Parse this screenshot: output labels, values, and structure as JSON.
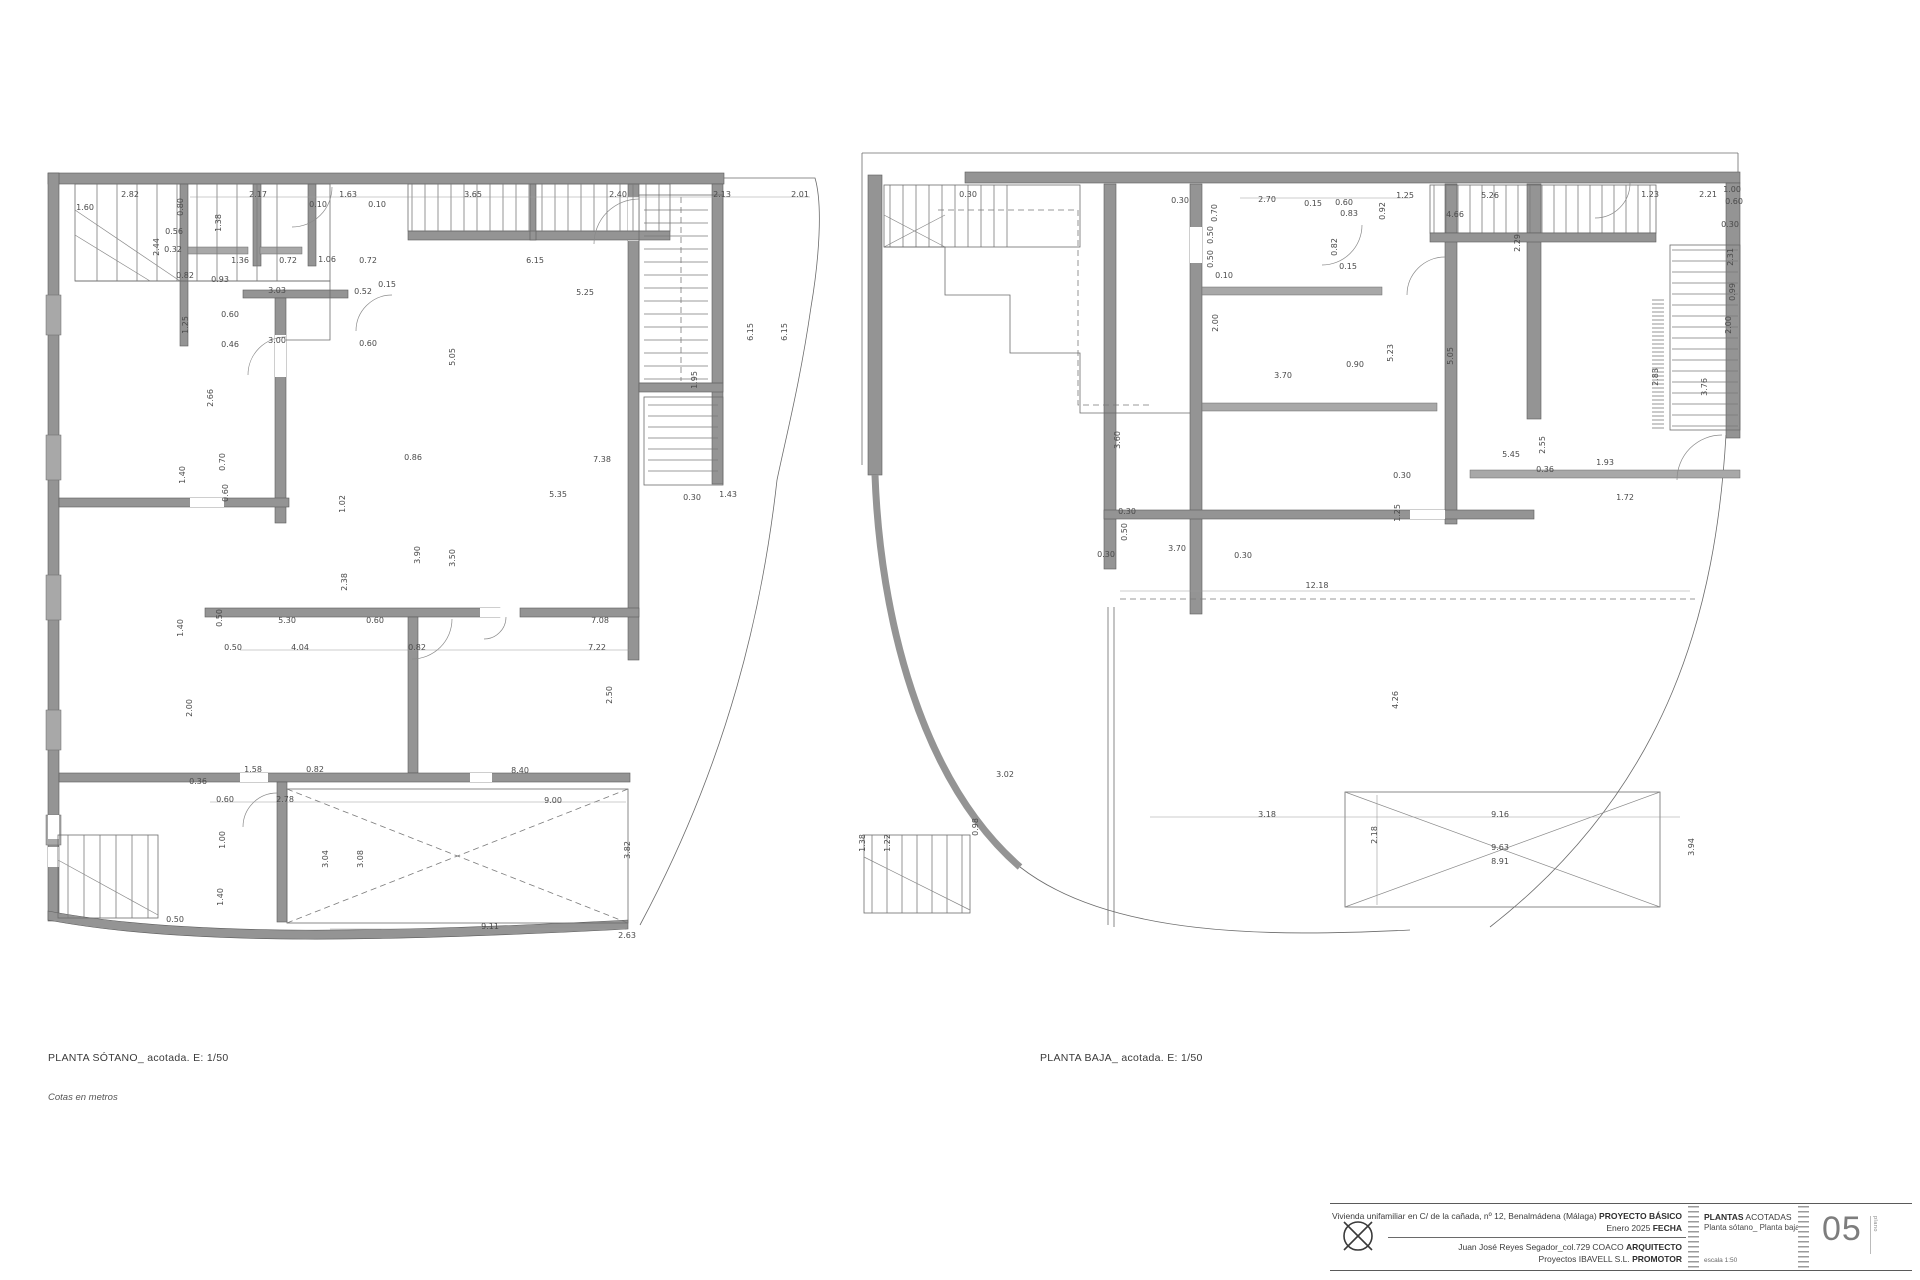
{
  "colors": {
    "wall": "#949494",
    "line": "#6b6b6b",
    "dim_text": "#4a4a4a",
    "accent": "#7d7d7d"
  },
  "labels": {
    "plan1_title": "PLANTA SÓTANO_ acotada. E: 1/50",
    "plan1_note": "Cotas en metros",
    "plan2_title": "PLANTA BAJA_ acotada. E: 1/50"
  },
  "titleblock": {
    "project": "Vivienda unifamiliar en C/ de la cañada, nº 12, Benalmádena (Málaga) ",
    "project_tag": "PROYECTO BÁSICO",
    "date": "Enero 2025 ",
    "date_tag": "FECHA",
    "architect": "Juan José Reyes Segador_col.729 COACO ",
    "architect_tag": "ARQUITECTO",
    "promoter": "Proyectos IBAVELL S.L. ",
    "promoter_tag": "PROMOTOR",
    "sheet_title_bold": "PLANTAS",
    "sheet_title_rest": " ACOTADAS",
    "sheet_subtitle": "Planta sótano_ Planta baja",
    "scale_label": "escala 1:50",
    "sheet_number": "05",
    "sheet_number_side": "plano"
  },
  "plans": [
    {
      "name": "planta-sotano",
      "dims": [
        [
          90,
          62,
          "2.82"
        ],
        [
          45,
          75,
          "1.60"
        ],
        [
          218,
          62,
          "2.17"
        ],
        [
          308,
          62,
          "1.63"
        ],
        [
          433,
          62,
          "3.65"
        ],
        [
          578,
          62,
          "2.40"
        ],
        [
          682,
          62,
          "2.13"
        ],
        [
          760,
          62,
          "2.01"
        ],
        [
          181,
          88,
          "1.38",
          "v"
        ],
        [
          119,
          112,
          "2.44",
          "v"
        ],
        [
          134,
          99,
          "0.56"
        ],
        [
          133,
          117,
          "0.32"
        ],
        [
          143,
          72,
          "0.80",
          "v"
        ],
        [
          278,
          72,
          "0.10"
        ],
        [
          337,
          72,
          "0.10"
        ],
        [
          200,
          128,
          "1.36"
        ],
        [
          248,
          128,
          "0.72"
        ],
        [
          287,
          127,
          "1.06"
        ],
        [
          328,
          128,
          "0.72"
        ],
        [
          180,
          147,
          "0.93"
        ],
        [
          145,
          143,
          "0.82"
        ],
        [
          237,
          158,
          "3.03"
        ],
        [
          323,
          159,
          "0.52"
        ],
        [
          347,
          152,
          "0.15"
        ],
        [
          190,
          182,
          "0.60"
        ],
        [
          148,
          190,
          "1.25",
          "v"
        ],
        [
          190,
          212,
          "0.46"
        ],
        [
          237,
          208,
          "3.00"
        ],
        [
          328,
          211,
          "0.60"
        ],
        [
          495,
          128,
          "6.15"
        ],
        [
          545,
          160,
          "5.25"
        ],
        [
          415,
          222,
          "5.05",
          "v"
        ],
        [
          713,
          197,
          "6.15",
          "v"
        ],
        [
          747,
          197,
          "6.15",
          "v"
        ],
        [
          657,
          245,
          "1.95",
          "v"
        ],
        [
          562,
          327,
          "7.38"
        ],
        [
          518,
          362,
          "5.35"
        ],
        [
          652,
          365,
          "0.30"
        ],
        [
          688,
          362,
          "1.43"
        ],
        [
          305,
          369,
          "1.02",
          "v"
        ],
        [
          380,
          420,
          "3.90",
          "v"
        ],
        [
          415,
          423,
          "3.50",
          "v"
        ],
        [
          307,
          447,
          "2.38",
          "v"
        ],
        [
          173,
          263,
          "2.66",
          "v"
        ],
        [
          185,
          327,
          "0.70",
          "v"
        ],
        [
          145,
          340,
          "1.40",
          "v"
        ],
        [
          188,
          358,
          "0.60",
          "v"
        ],
        [
          373,
          325,
          "0.86"
        ],
        [
          143,
          493,
          "1.40",
          "v"
        ],
        [
          182,
          483,
          "0.50",
          "v"
        ],
        [
          247,
          488,
          "5.30"
        ],
        [
          335,
          488,
          "0.60"
        ],
        [
          560,
          488,
          "7.08"
        ],
        [
          193,
          515,
          "0.50"
        ],
        [
          260,
          515,
          "4.04"
        ],
        [
          377,
          515,
          "0.82"
        ],
        [
          557,
          515,
          "7.22"
        ],
        [
          152,
          573,
          "2.00",
          "v"
        ],
        [
          572,
          560,
          "2.50",
          "v"
        ],
        [
          213,
          637,
          "1.58"
        ],
        [
          275,
          637,
          "0.82"
        ],
        [
          480,
          638,
          "8.40"
        ],
        [
          158,
          649,
          "0.36"
        ],
        [
          185,
          667,
          "0.60"
        ],
        [
          245,
          667,
          "2.78"
        ],
        [
          513,
          668,
          "9.00"
        ],
        [
          185,
          705,
          "1.00",
          "v"
        ],
        [
          183,
          762,
          "1.40",
          "v"
        ],
        [
          135,
          787,
          "0.50"
        ],
        [
          288,
          724,
          "3.04",
          "v"
        ],
        [
          323,
          724,
          "3.08",
          "v"
        ],
        [
          590,
          715,
          "3.82",
          "v"
        ],
        [
          450,
          794,
          "9.11"
        ],
        [
          587,
          803,
          "2.63"
        ]
      ]
    },
    {
      "name": "planta-baja",
      "dims": [
        [
          118,
          62,
          "0.30"
        ],
        [
          330,
          68,
          "0.30"
        ],
        [
          367,
          78,
          "0.70",
          "v"
        ],
        [
          417,
          67,
          "2.70"
        ],
        [
          463,
          71,
          "0.15"
        ],
        [
          494,
          70,
          "0.60"
        ],
        [
          499,
          81,
          "0.83"
        ],
        [
          535,
          76,
          "0.92",
          "v"
        ],
        [
          555,
          63,
          "1.25"
        ],
        [
          640,
          63,
          "5.26"
        ],
        [
          605,
          82,
          "4.66"
        ],
        [
          800,
          62,
          "1.23"
        ],
        [
          858,
          62,
          "2.21"
        ],
        [
          882,
          57,
          "1.00"
        ],
        [
          884,
          69,
          "0.60"
        ],
        [
          670,
          108,
          "2.29",
          "v"
        ],
        [
          880,
          92,
          "0.30"
        ],
        [
          883,
          122,
          "2.31",
          "v"
        ],
        [
          885,
          157,
          "0.99",
          "v"
        ],
        [
          881,
          190,
          "2.00",
          "v"
        ],
        [
          363,
          100,
          "0.50",
          "v"
        ],
        [
          363,
          124,
          "0.50",
          "v"
        ],
        [
          374,
          143,
          "0.10"
        ],
        [
          368,
          188,
          "2.00",
          "v"
        ],
        [
          487,
          112,
          "0.82",
          "v"
        ],
        [
          498,
          134,
          "0.15"
        ],
        [
          505,
          232,
          "0.90"
        ],
        [
          433,
          243,
          "3.70"
        ],
        [
          543,
          218,
          "5.23",
          "v"
        ],
        [
          603,
          221,
          "5.05",
          "v"
        ],
        [
          857,
          252,
          "3.76",
          "v"
        ],
        [
          808,
          242,
          "2.83",
          "v"
        ],
        [
          270,
          305,
          "3.60",
          "v"
        ],
        [
          277,
          379,
          "0.30"
        ],
        [
          277,
          397,
          "0.50",
          "v"
        ],
        [
          327,
          416,
          "3.70"
        ],
        [
          256,
          422,
          "0.30"
        ],
        [
          393,
          423,
          "0.30"
        ],
        [
          661,
          322,
          "5.45"
        ],
        [
          552,
          343,
          "0.30"
        ],
        [
          550,
          378,
          "1.25",
          "v"
        ],
        [
          695,
          310,
          "2.55",
          "v"
        ],
        [
          695,
          337,
          "0.36"
        ],
        [
          755,
          330,
          "1.93"
        ],
        [
          775,
          365,
          "1.72"
        ],
        [
          467,
          453,
          "12.18"
        ],
        [
          548,
          565,
          "4.26",
          "v"
        ],
        [
          417,
          682,
          "3.18"
        ],
        [
          650,
          682,
          "9.16"
        ],
        [
          527,
          700,
          "2.18",
          "v"
        ],
        [
          650,
          715,
          "9.63"
        ],
        [
          650,
          729,
          "8.91"
        ],
        [
          844,
          712,
          "3.94",
          "v"
        ],
        [
          155,
          642,
          "3.02"
        ],
        [
          15,
          708,
          "1.38",
          "v"
        ],
        [
          40,
          708,
          "1.22",
          "v"
        ],
        [
          128,
          692,
          "0.98",
          "v"
        ]
      ]
    }
  ]
}
